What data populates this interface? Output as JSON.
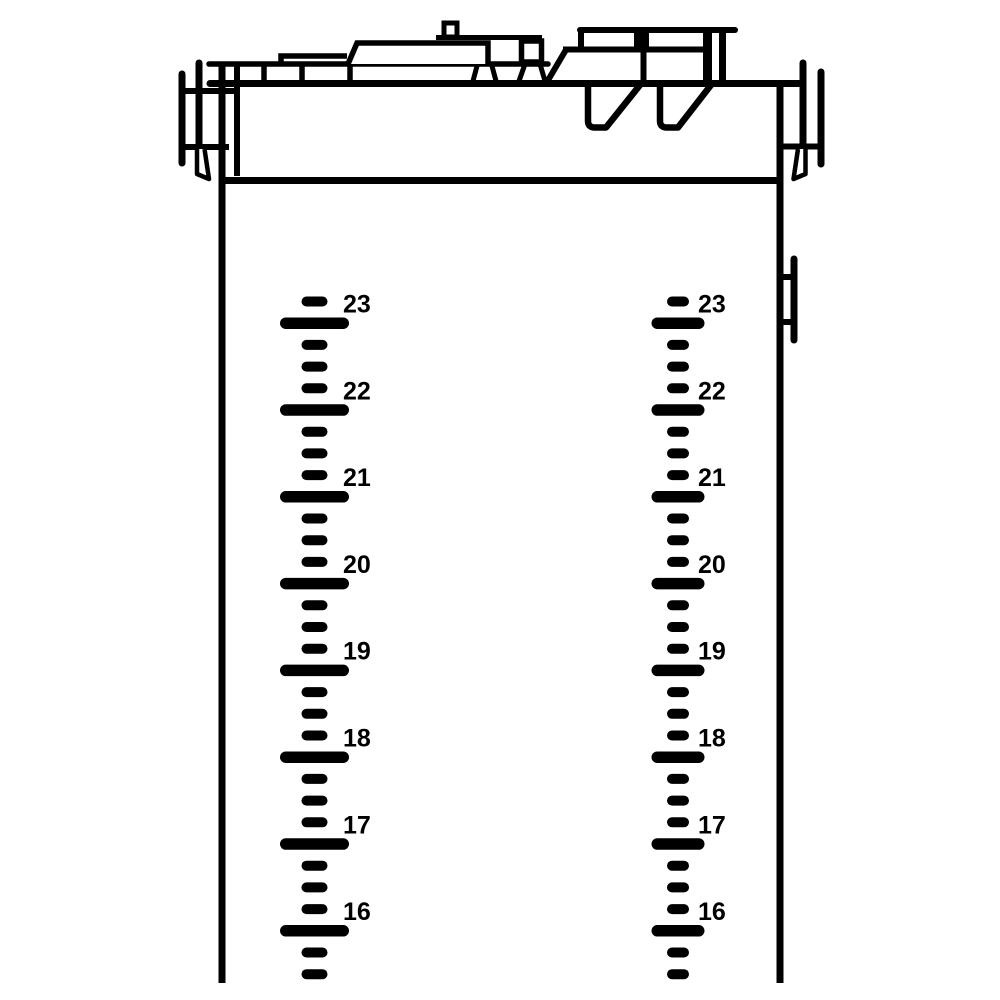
{
  "page": {
    "background": "#ffffff"
  },
  "diagram": {
    "kind": "tank-cross-section-line-drawing",
    "line_color": "#000000",
    "level_scales": {
      "values": [
        23,
        22,
        21,
        20,
        19,
        18,
        17,
        16
      ],
      "unit_labels": [
        "23",
        "22",
        "21",
        "20",
        "19",
        "18",
        "17",
        "16"
      ],
      "minor_ticks_between_majors": 3,
      "top_y": 301.5,
      "tick_step": 21.7,
      "tick_count": 32,
      "label_font_size": 25,
      "label_dy": 3,
      "instances": [
        {
          "id": "left",
          "center_x": 314.5,
          "label_x": 343,
          "short_w": 26,
          "short_h": 10,
          "long_w": 69,
          "long_h": 11.5
        },
        {
          "id": "right",
          "center_x": 678,
          "label_x": 698,
          "short_w": 22,
          "short_h": 10,
          "long_w": 53,
          "long_h": 11.5
        }
      ]
    }
  }
}
